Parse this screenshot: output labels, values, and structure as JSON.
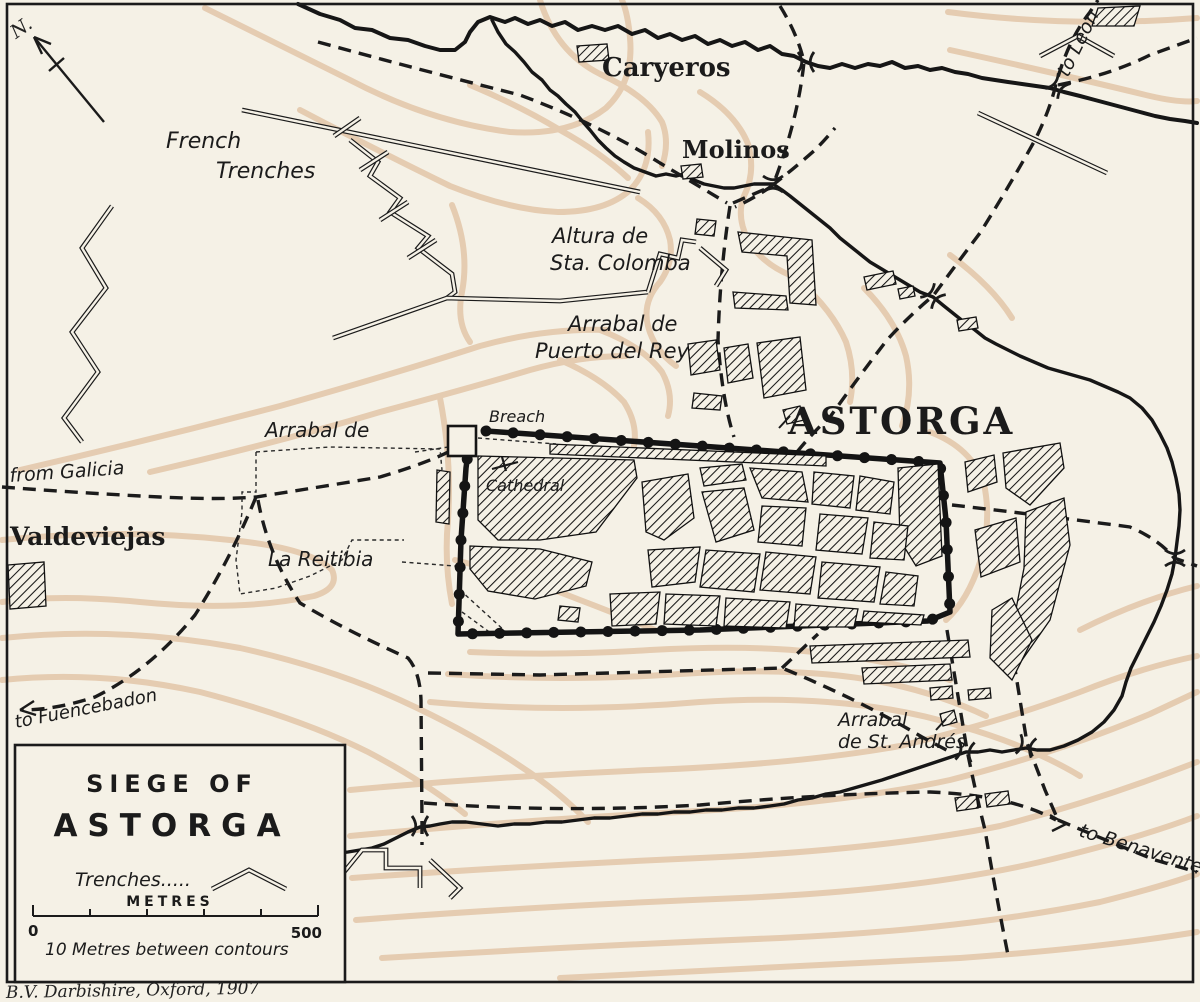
{
  "page_title": "Siege of Astorga map plate",
  "colors": {
    "paper": "#f5f1e6",
    "ink": "#1b1b1b",
    "contour_tan": "#d7ab82",
    "hatch": "#141414"
  },
  "compass": {
    "label": "N."
  },
  "labels": {
    "caryeros": "Caryeros",
    "molinos": "Molinos",
    "french_trenches_line1": "French",
    "french_trenches_line2": "Trenches",
    "altura_line1": "Altura de",
    "altura_line2": "Sta. Colomba",
    "puerto_line1": "Arrabal de",
    "puerto_line2": "Puerto del Rey",
    "astorga": "ASTORGA",
    "breach": "Breach",
    "cathedral": "Cathedral",
    "reitibia_line1": "Arrabal de",
    "reitibia_line2": "La Reitibia",
    "valdeviejas": "Valdeviejas",
    "from_galicia": "from Galicia",
    "to_fuencebadon": "to Fuencebadon",
    "st_andres_line1": "Arrabal",
    "st_andres_line2": "de St. Andrés",
    "to_benavente": "to Benavente",
    "to_leon": "to Leon"
  },
  "legend": {
    "title_line1": "SIEGE OF",
    "title_line2": "ASTORGA",
    "trenches_label": "Trenches.....",
    "scale_caption": "METRES",
    "scale_min": "0",
    "scale_max": "500",
    "contour_note": "10 Metres between contours"
  },
  "credit": "B.V. Darbishire, Oxford, 1907"
}
